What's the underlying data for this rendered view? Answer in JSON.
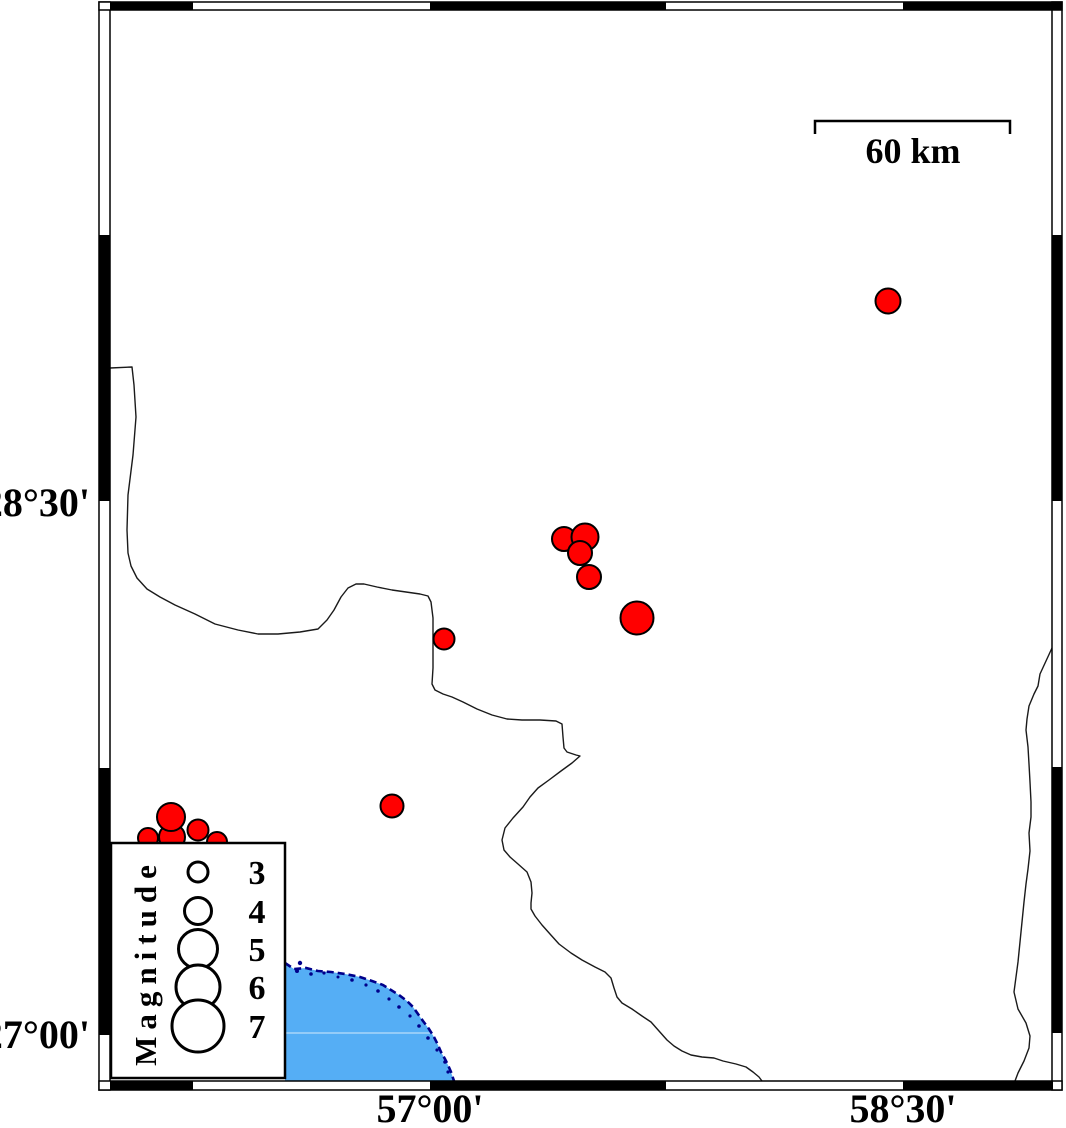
{
  "figure": {
    "type": "seismicity-map",
    "background": "#ffffff"
  },
  "map": {
    "frame": {
      "style": "fancy-alternating-black-white",
      "tick_labels_left": [
        {
          "label": "28°30'",
          "y": 501
        },
        {
          "label": "27°00'",
          "y": 1033
        }
      ],
      "tick_labels_bottom": [
        {
          "label": "57°00'",
          "x": 430
        },
        {
          "label": "58°30'",
          "x": 903
        }
      ]
    },
    "scale_bar": {
      "label": "60 km",
      "x1": 815,
      "x2": 1010,
      "y": 121
    },
    "water_color": "#55aef5",
    "coast_color": "#00008b",
    "boundary_color": "#1a1a1a"
  },
  "legend": {
    "title": "Magnitude",
    "entries": [
      {
        "label": "3",
        "radius": 10
      },
      {
        "label": "4",
        "radius": 13.5
      },
      {
        "label": "5",
        "radius": 19.5
      },
      {
        "label": "6",
        "radius": 22
      },
      {
        "label": "7",
        "radius": 26
      }
    ]
  },
  "earthquakes": {
    "marker_color": "#ff0000",
    "marker_outline": "#000000",
    "points": [
      {
        "x": 888,
        "y": 301,
        "r": 12.5
      },
      {
        "x": 564,
        "y": 539,
        "r": 12
      },
      {
        "x": 585,
        "y": 537,
        "r": 13.5
      },
      {
        "x": 580,
        "y": 553,
        "r": 12
      },
      {
        "x": 589,
        "y": 577,
        "r": 12
      },
      {
        "x": 637,
        "y": 618,
        "r": 16.5
      },
      {
        "x": 444,
        "y": 639,
        "r": 10.5
      },
      {
        "x": 392,
        "y": 806,
        "r": 11.5
      },
      {
        "x": 148,
        "y": 838,
        "r": 10
      },
      {
        "x": 217,
        "y": 842,
        "r": 10
      },
      {
        "x": 172,
        "y": 837,
        "r": 13
      },
      {
        "x": 198,
        "y": 830,
        "r": 10.5
      },
      {
        "x": 171,
        "y": 817,
        "r": 14
      }
    ]
  },
  "geography": {
    "boundary_west": [
      [
        110,
        368
      ],
      [
        132,
        367
      ],
      [
        134,
        385
      ],
      [
        136,
        417
      ],
      [
        133,
        455
      ],
      [
        128,
        495
      ],
      [
        127,
        530
      ],
      [
        128,
        553
      ],
      [
        131,
        566
      ],
      [
        137,
        578
      ],
      [
        147,
        589
      ],
      [
        160,
        597
      ],
      [
        175,
        605
      ],
      [
        195,
        614
      ],
      [
        215,
        624
      ],
      [
        238,
        630
      ],
      [
        258,
        634
      ],
      [
        278,
        634
      ],
      [
        300,
        632
      ],
      [
        318,
        629
      ],
      [
        327,
        620
      ],
      [
        334,
        610
      ],
      [
        341,
        597
      ],
      [
        348,
        588
      ],
      [
        356,
        584
      ],
      [
        364,
        584
      ],
      [
        377,
        587
      ],
      [
        392,
        590
      ],
      [
        406,
        592
      ],
      [
        420,
        594
      ],
      [
        428,
        596
      ],
      [
        431,
        602
      ],
      [
        433,
        618
      ],
      [
        433,
        645
      ],
      [
        433,
        668
      ],
      [
        432,
        684
      ],
      [
        435,
        690
      ],
      [
        443,
        694
      ],
      [
        452,
        697
      ],
      [
        463,
        702
      ],
      [
        477,
        709
      ],
      [
        492,
        715
      ],
      [
        507,
        719
      ],
      [
        522,
        720
      ],
      [
        540,
        720
      ],
      [
        556,
        721
      ],
      [
        562,
        724
      ],
      [
        563,
        737
      ],
      [
        564,
        748
      ],
      [
        567,
        752
      ],
      [
        576,
        755
      ],
      [
        580,
        756
      ],
      [
        572,
        763
      ],
      [
        561,
        771
      ],
      [
        549,
        780
      ],
      [
        538,
        788
      ],
      [
        530,
        797
      ],
      [
        523,
        807
      ],
      [
        513,
        818
      ],
      [
        505,
        828
      ],
      [
        502,
        840
      ],
      [
        504,
        850
      ],
      [
        510,
        857
      ],
      [
        518,
        864
      ],
      [
        527,
        872
      ],
      [
        531,
        882
      ],
      [
        532,
        893
      ],
      [
        531,
        903
      ],
      [
        531,
        909
      ],
      [
        535,
        916
      ],
      [
        542,
        925
      ],
      [
        550,
        934
      ],
      [
        559,
        944
      ],
      [
        571,
        953
      ],
      [
        582,
        960
      ],
      [
        595,
        967
      ],
      [
        605,
        972
      ],
      [
        611,
        978
      ],
      [
        614,
        988
      ],
      [
        617,
        997
      ],
      [
        622,
        1003
      ],
      [
        632,
        1009
      ],
      [
        642,
        1016
      ],
      [
        651,
        1022
      ],
      [
        659,
        1031
      ],
      [
        667,
        1040
      ],
      [
        674,
        1046
      ],
      [
        682,
        1051
      ],
      [
        691,
        1055
      ],
      [
        702,
        1057
      ],
      [
        714,
        1058
      ],
      [
        723,
        1061
      ],
      [
        736,
        1064
      ],
      [
        746,
        1067
      ],
      [
        753,
        1072
      ],
      [
        759,
        1077
      ],
      [
        762,
        1081
      ]
    ],
    "boundary_east": [
      [
        1052,
        648
      ],
      [
        1046,
        661
      ],
      [
        1040,
        674
      ],
      [
        1038,
        686
      ],
      [
        1034,
        694
      ],
      [
        1029,
        706
      ],
      [
        1027,
        719
      ],
      [
        1026,
        730
      ],
      [
        1028,
        747
      ],
      [
        1029,
        764
      ],
      [
        1030,
        782
      ],
      [
        1031,
        802
      ],
      [
        1031,
        817
      ],
      [
        1029,
        833
      ],
      [
        1030,
        851
      ],
      [
        1028,
        869
      ],
      [
        1026,
        884
      ],
      [
        1024,
        902
      ],
      [
        1021,
        932
      ],
      [
        1018,
        962
      ],
      [
        1014,
        992
      ],
      [
        1018,
        1009
      ],
      [
        1026,
        1023
      ],
      [
        1030,
        1036
      ],
      [
        1029,
        1048
      ],
      [
        1024,
        1061
      ],
      [
        1018,
        1073
      ],
      [
        1015,
        1081
      ]
    ],
    "coastline": [
      [
        285,
        963
      ],
      [
        294,
        969
      ],
      [
        306,
        968
      ],
      [
        318,
        971
      ],
      [
        331,
        972
      ],
      [
        345,
        974
      ],
      [
        360,
        977
      ],
      [
        372,
        981
      ],
      [
        383,
        985
      ],
      [
        391,
        990
      ],
      [
        399,
        995
      ],
      [
        407,
        1001
      ],
      [
        413,
        1007
      ],
      [
        418,
        1014
      ],
      [
        423,
        1021
      ],
      [
        429,
        1029
      ],
      [
        434,
        1037
      ],
      [
        438,
        1045
      ],
      [
        441,
        1052
      ],
      [
        445,
        1059
      ],
      [
        448,
        1065
      ],
      [
        451,
        1072
      ],
      [
        453,
        1078
      ],
      [
        454,
        1081
      ]
    ],
    "islets": [
      [
        297,
        971,
        2
      ],
      [
        311,
        974,
        1.8
      ],
      [
        324,
        973,
        1.6
      ],
      [
        338,
        977,
        1.5
      ],
      [
        352,
        980,
        1.8
      ],
      [
        366,
        985,
        1.6
      ],
      [
        378,
        991,
        1.8
      ],
      [
        389,
        999,
        1.6
      ],
      [
        399,
        1007,
        1.8
      ],
      [
        410,
        1016,
        1.6
      ],
      [
        300,
        963,
        2.2
      ],
      [
        419,
        1026,
        1.8
      ],
      [
        428,
        1038,
        1.8
      ],
      [
        437,
        1050,
        1.6
      ],
      [
        445,
        1062,
        1.8
      ],
      [
        448,
        1072,
        1.6
      ]
    ]
  }
}
